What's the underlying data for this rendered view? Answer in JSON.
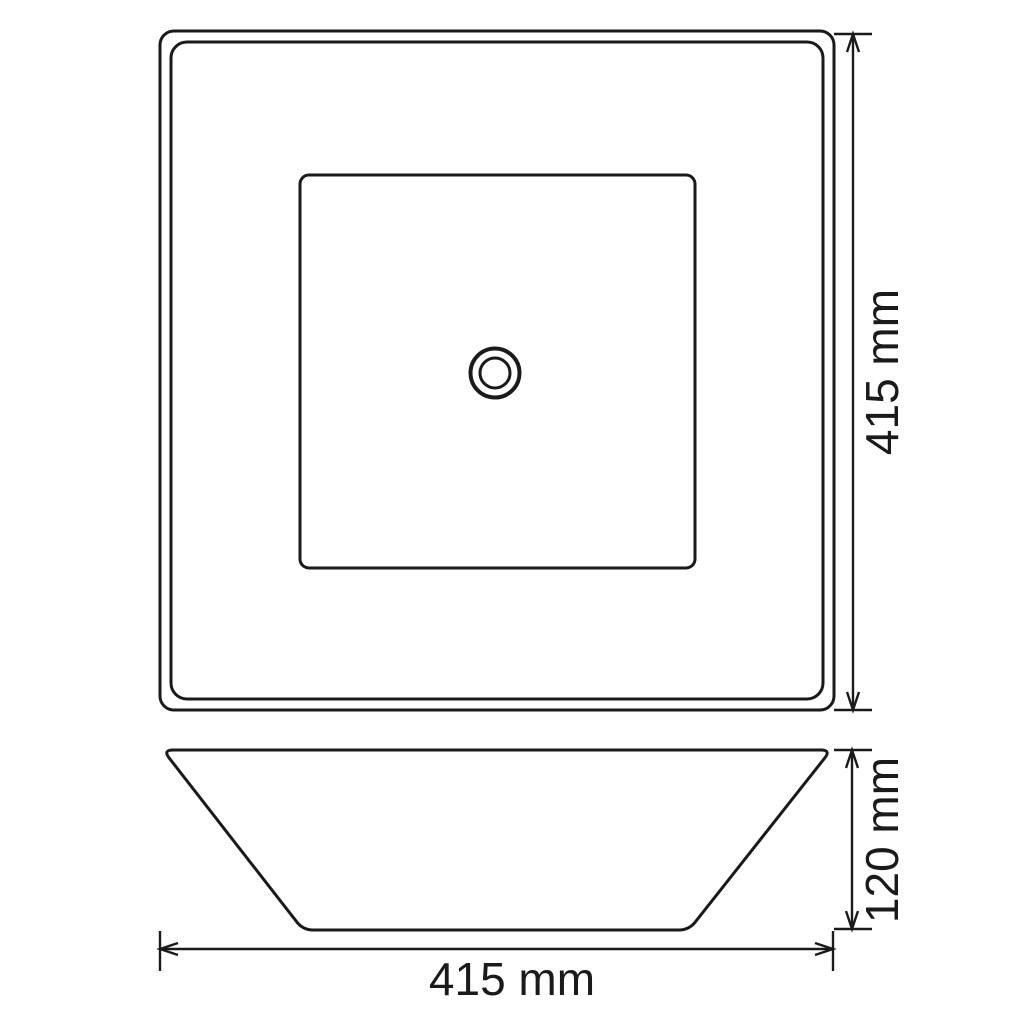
{
  "colors": {
    "background": "#ffffff",
    "line": "#1a1a1a"
  },
  "dimensions": {
    "top_view_height": "415 mm",
    "side_view_height": "120 mm",
    "side_view_width": "415 mm"
  }
}
